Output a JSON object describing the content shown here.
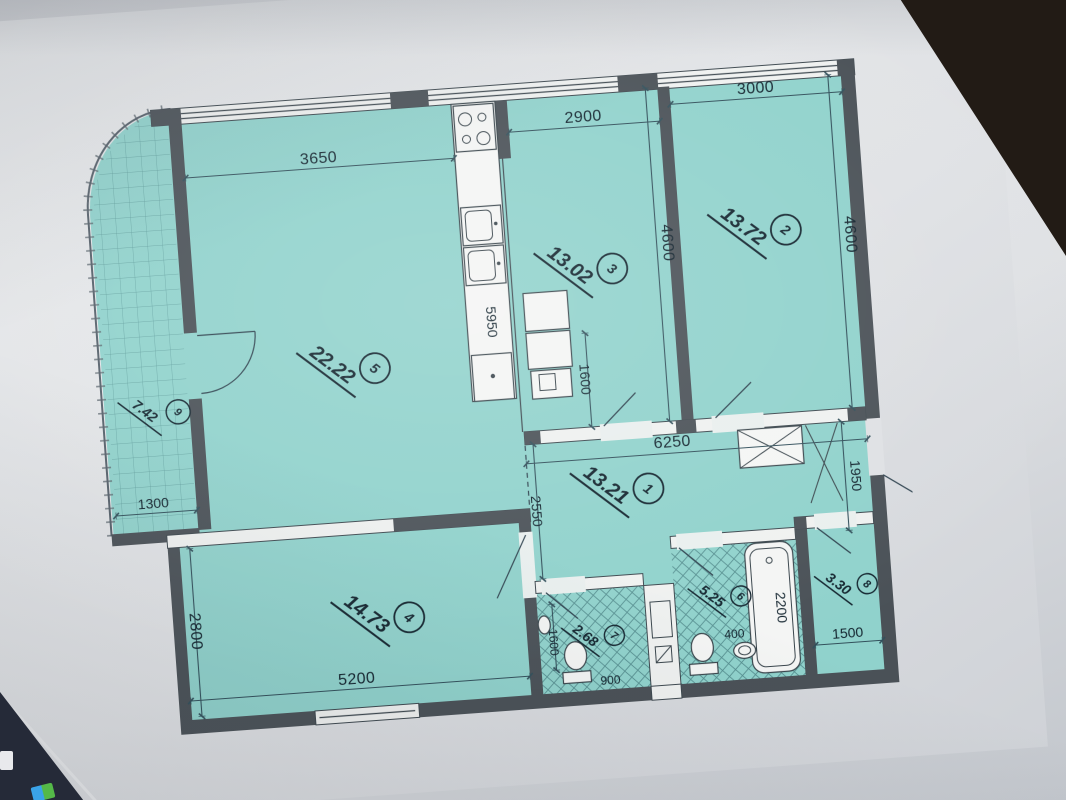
{
  "floorplan": {
    "rooms": [
      {
        "number": "1",
        "area": "13.21"
      },
      {
        "number": "2",
        "area": "13.72"
      },
      {
        "number": "3",
        "area": "13.02"
      },
      {
        "number": "4",
        "area": "14.73"
      },
      {
        "number": "5",
        "area": "22.22"
      },
      {
        "number": "6",
        "area": "5.25"
      },
      {
        "number": "7",
        "area": "2.68"
      },
      {
        "number": "8",
        "area": "3.30"
      },
      {
        "number": "9",
        "area": "7.42"
      }
    ],
    "dims": {
      "room5_top": "3650",
      "room3_top": "2900",
      "room2_top": "3000",
      "room3_side": "4600",
      "room2_side": "4600",
      "kitchen_run": "5950",
      "room3_niche": "1600",
      "hall_width": "6250",
      "entry_side": "1950",
      "hall_left": "2550",
      "balcony_width": "1300",
      "room4_side": "2800",
      "room4_bottom": "5200",
      "wc_side": "1600",
      "wc_bottom": "900",
      "bath_niche": "400",
      "tub_length": "2200",
      "room8_bottom": "1500"
    },
    "colors": {
      "floor": "#8ed3cc",
      "wall": "#4a5157",
      "line": "#31505c",
      "text": "#12242f",
      "screen_corner": "#221b15",
      "taskbar": "#252a38",
      "logo_blue": "#3aa3e8",
      "logo_green": "#54b948"
    }
  }
}
